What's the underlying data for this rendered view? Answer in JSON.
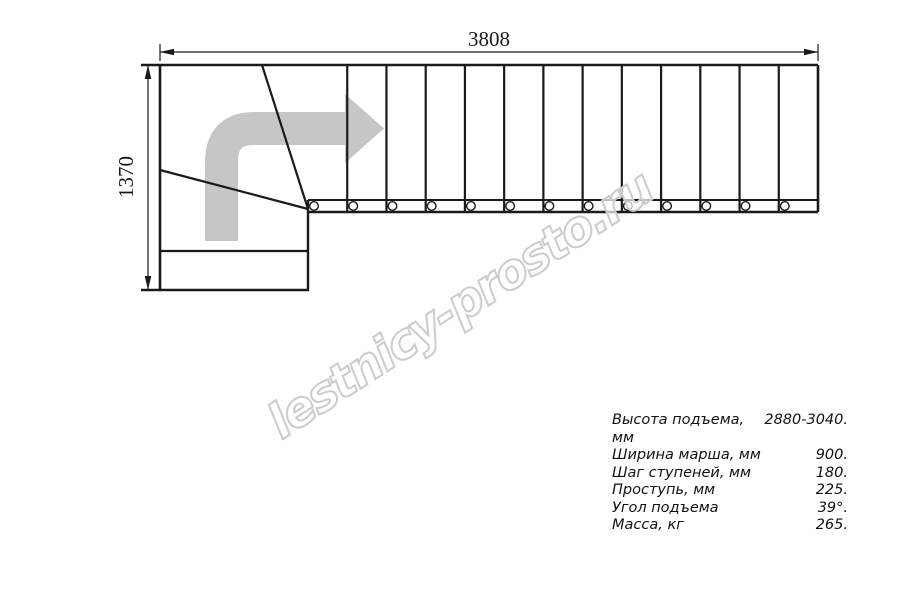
{
  "drawing": {
    "title": "staircase-plan-top-view",
    "length_dim_label": "3808",
    "width_dim_label": "1370",
    "tread_count": 13,
    "run_left_x": 308,
    "run_right_x": 818,
    "run_top_y": 65,
    "band_top_y": 200,
    "band_bottom_y": 212,
    "line_color": "#1a1a1a",
    "arrow_color": "#c6c6c6"
  },
  "watermark": {
    "text": "lestnicy-prosto.ru",
    "color": "#cccccc"
  },
  "specs": {
    "rows": [
      {
        "label": "Высота подъема, мм",
        "value": "2880-3040."
      },
      {
        "label": "Ширина марша, мм",
        "value": "900."
      },
      {
        "label": "Шаг ступеней, мм",
        "value": "180."
      },
      {
        "label": "Проступь, мм",
        "value": "225."
      },
      {
        "label": "Угол подъема",
        "value": "39°."
      },
      {
        "label": "Масса, кг",
        "value": "265."
      }
    ]
  }
}
